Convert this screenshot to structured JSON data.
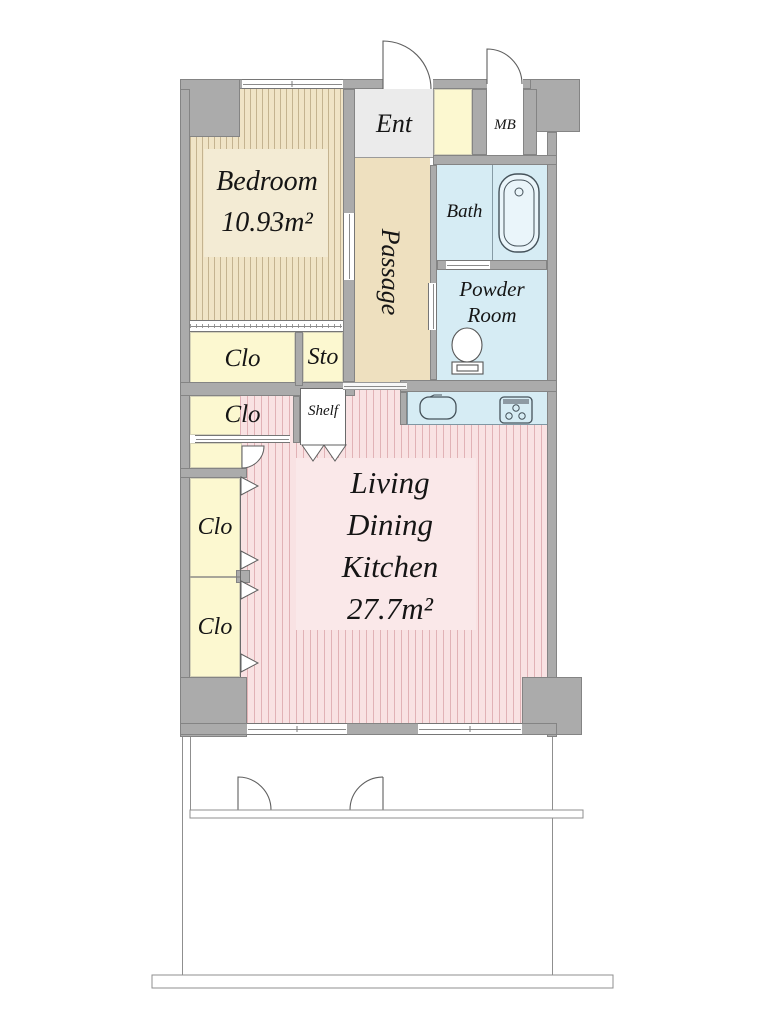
{
  "title": "Apartment floor plan",
  "rooms": {
    "bedroom": {
      "name": "Bedroom",
      "area": "10.93m²"
    },
    "entrance": {
      "name": "Ent"
    },
    "meter_box": {
      "name": "MB"
    },
    "bath": {
      "name": "Bath"
    },
    "powder_room": {
      "line1": "Powder",
      "line2": "Room"
    },
    "passage": {
      "name": "Passage"
    },
    "closet_top_1": {
      "name": "Clo"
    },
    "storage": {
      "name": "Sto"
    },
    "closet_top_2": {
      "name": "Clo"
    },
    "shelf": {
      "name": "Shelf"
    },
    "closet_left_1": {
      "name": "Clo"
    },
    "closet_left_2": {
      "name": "Clo"
    },
    "ldk": {
      "line1": "Living",
      "line2": "Dining",
      "line3": "Kitchen",
      "area": "27.7m²"
    }
  },
  "colors": {
    "wall": "#ababab",
    "bedroom_floor": "#f0e4c6",
    "passage_floor": "#eee0bf",
    "wet_area": "#d6ecf4",
    "closet": "#fcf8d0",
    "ldk_floor": "#f9e2e3",
    "entrance_floor": "#ebebeb"
  }
}
